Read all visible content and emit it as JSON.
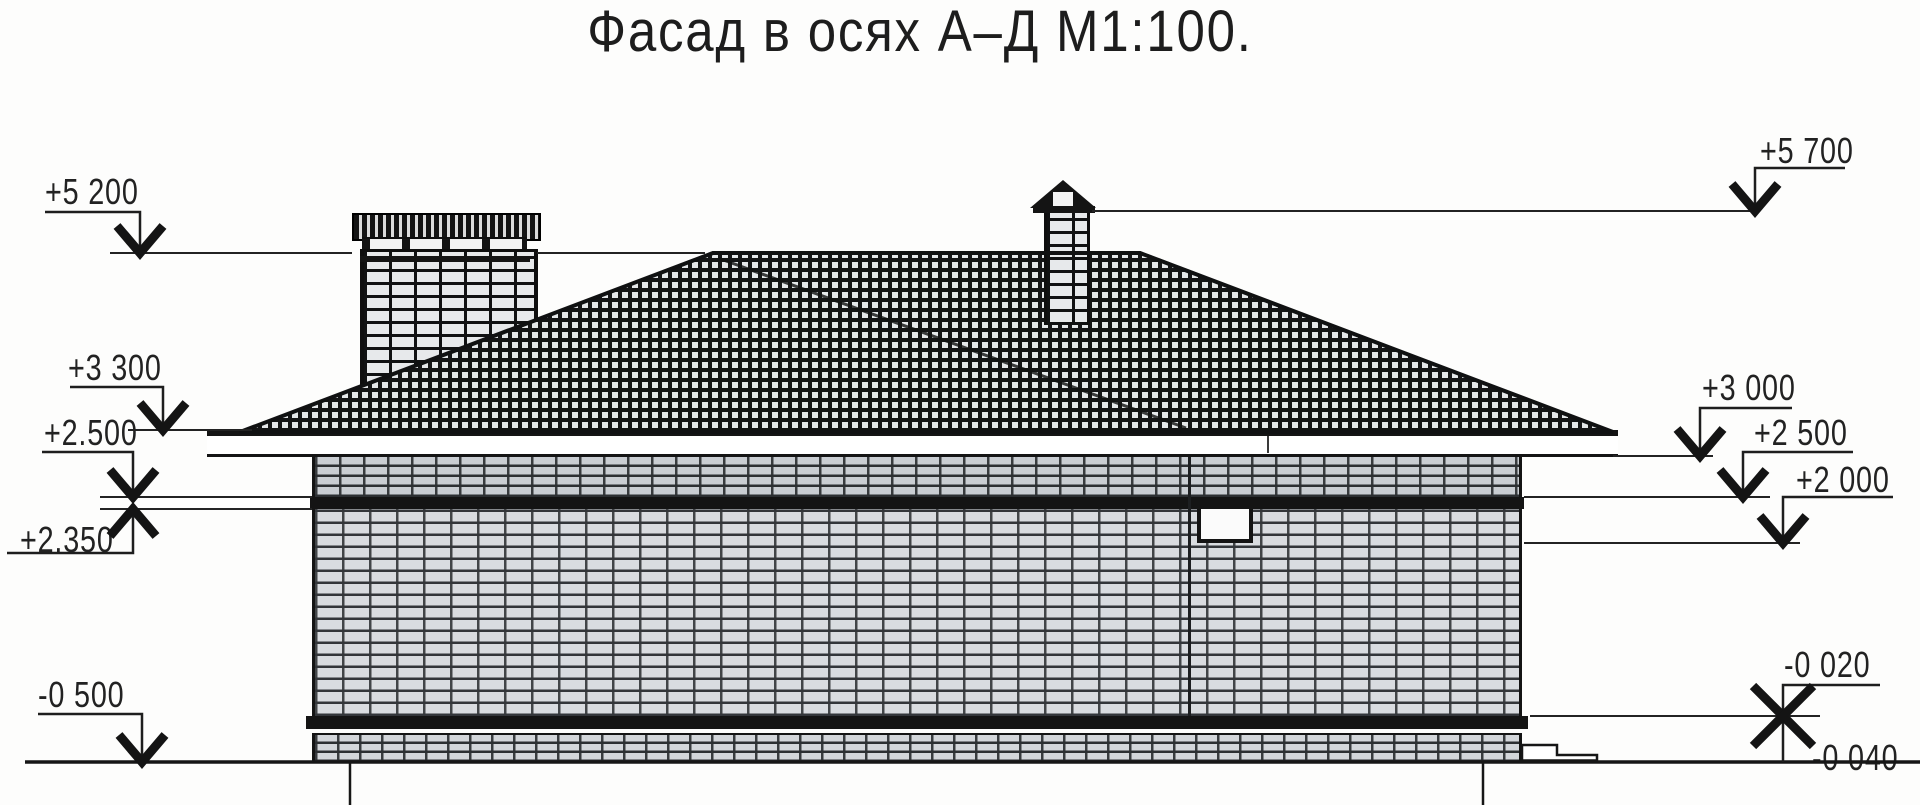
{
  "title": "Фасад в осях А–Д М1:100.",
  "drawing": {
    "type": "facade-elevation",
    "axes": "А–Д",
    "scale": "М1:100"
  },
  "elevation_marks": {
    "left": [
      {
        "id": "plus-5-200",
        "label": "+5 200"
      },
      {
        "id": "plus-3-300",
        "label": "+3 300"
      },
      {
        "id": "plus-2-500",
        "label": "+2.500"
      },
      {
        "id": "plus-2-350",
        "label": "+2.350"
      },
      {
        "id": "minus-0-500",
        "label": "-0 500"
      }
    ],
    "right": [
      {
        "id": "plus-5-700",
        "label": "+5 700"
      },
      {
        "id": "plus-3-000",
        "label": "+3 000"
      },
      {
        "id": "plus-2-500",
        "label": "+2 500"
      },
      {
        "id": "plus-2-000",
        "label": "+2 000"
      },
      {
        "id": "minus-0-020",
        "label": "-0 020"
      },
      {
        "id": "minus-0-040",
        "label": "-0 040"
      }
    ]
  }
}
